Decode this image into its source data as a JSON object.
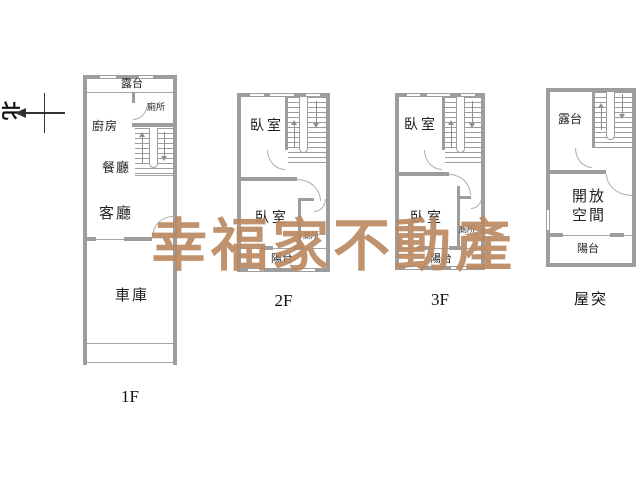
{
  "compass": {
    "north": "北"
  },
  "watermark": {
    "text": "幸福家不動產",
    "color": "#bb8a62"
  },
  "floors": {
    "f1": {
      "label": "1F",
      "rooms": {
        "terrace": "露台",
        "kitchen": "廚房",
        "toilet": "廁所",
        "dining": "餐廳",
        "living": "客廳",
        "garage": "車庫"
      }
    },
    "f2": {
      "label": "2F",
      "rooms": {
        "bedroom_upper": "臥室",
        "bedroom_lower": "臥室",
        "toilet": "廁所",
        "balcony": "陽台"
      }
    },
    "f3": {
      "label": "3F",
      "rooms": {
        "bedroom_upper": "臥室",
        "bedroom_lower": "臥室",
        "toilet": "廁所",
        "balcony": "陽台"
      }
    },
    "f4": {
      "label": "屋突",
      "rooms": {
        "terrace": "露台",
        "open_space_1": "開放",
        "open_space_2": "空間",
        "balcony": "陽台"
      }
    }
  }
}
